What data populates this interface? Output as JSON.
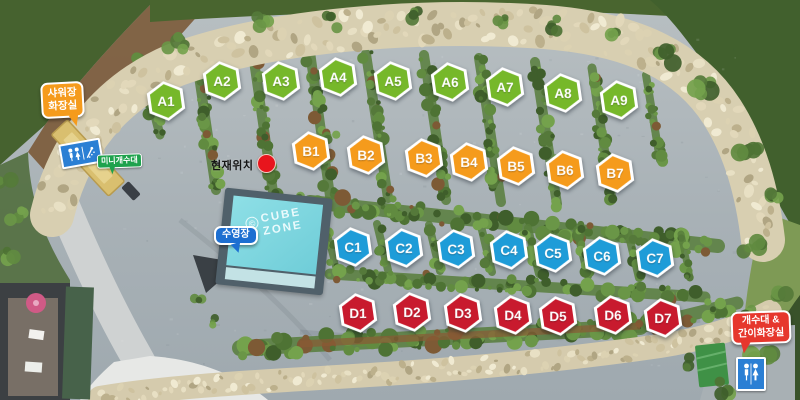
{
  "map": {
    "name": "campground-site-map",
    "current_location": {
      "label": "현재위치",
      "dot_color": "#e8151d"
    },
    "pool": {
      "bubble_label": "수영장",
      "bubble_color": "#1d6fd1",
      "logo_copyright": "©",
      "logo_line1": "CUBE",
      "logo_line2": "ZONE",
      "water_color": "#7fd6de"
    },
    "signs": {
      "shower_toilet": {
        "line1": "샤워장",
        "line2": "화장실",
        "color": "#f59b1c"
      },
      "mini_sink": {
        "label": "미니개수대",
        "color": "#1ea24d"
      },
      "sink_portable_toilet": {
        "line1": "개수대 &",
        "line2": "간이화장실",
        "color": "#e6372d"
      },
      "restroom_icon_color": "#2b7fd4"
    },
    "site_rows": [
      {
        "row": "A",
        "color": "#76b82a",
        "sites": [
          {
            "label": "A1",
            "x": 166,
            "y": 101
          },
          {
            "label": "A2",
            "x": 222,
            "y": 81
          },
          {
            "label": "A3",
            "x": 281,
            "y": 81
          },
          {
            "label": "A4",
            "x": 338,
            "y": 77
          },
          {
            "label": "A5",
            "x": 393,
            "y": 81
          },
          {
            "label": "A6",
            "x": 450,
            "y": 82
          },
          {
            "label": "A7",
            "x": 505,
            "y": 87
          },
          {
            "label": "A8",
            "x": 563,
            "y": 93
          },
          {
            "label": "A9",
            "x": 619,
            "y": 100
          }
        ]
      },
      {
        "row": "B",
        "color": "#f59b1c",
        "sites": [
          {
            "label": "B1",
            "x": 311,
            "y": 151
          },
          {
            "label": "B2",
            "x": 366,
            "y": 155
          },
          {
            "label": "B3",
            "x": 424,
            "y": 158
          },
          {
            "label": "B4",
            "x": 469,
            "y": 162
          },
          {
            "label": "B5",
            "x": 516,
            "y": 166
          },
          {
            "label": "B6",
            "x": 565,
            "y": 170
          },
          {
            "label": "B7",
            "x": 615,
            "y": 173
          }
        ]
      },
      {
        "row": "C",
        "color": "#1e9cd8",
        "sites": [
          {
            "label": "C1",
            "x": 353,
            "y": 247
          },
          {
            "label": "C2",
            "x": 404,
            "y": 248
          },
          {
            "label": "C3",
            "x": 456,
            "y": 249
          },
          {
            "label": "C4",
            "x": 509,
            "y": 250
          },
          {
            "label": "C5",
            "x": 553,
            "y": 253
          },
          {
            "label": "C6",
            "x": 602,
            "y": 256
          },
          {
            "label": "C7",
            "x": 655,
            "y": 258
          }
        ]
      },
      {
        "row": "D",
        "color": "#c81a2e",
        "sites": [
          {
            "label": "D1",
            "x": 358,
            "y": 313
          },
          {
            "label": "D2",
            "x": 412,
            "y": 312
          },
          {
            "label": "D3",
            "x": 463,
            "y": 313
          },
          {
            "label": "D4",
            "x": 513,
            "y": 315
          },
          {
            "label": "D5",
            "x": 558,
            "y": 316
          },
          {
            "label": "D6",
            "x": 613,
            "y": 315
          },
          {
            "label": "D7",
            "x": 663,
            "y": 318
          }
        ]
      }
    ]
  }
}
